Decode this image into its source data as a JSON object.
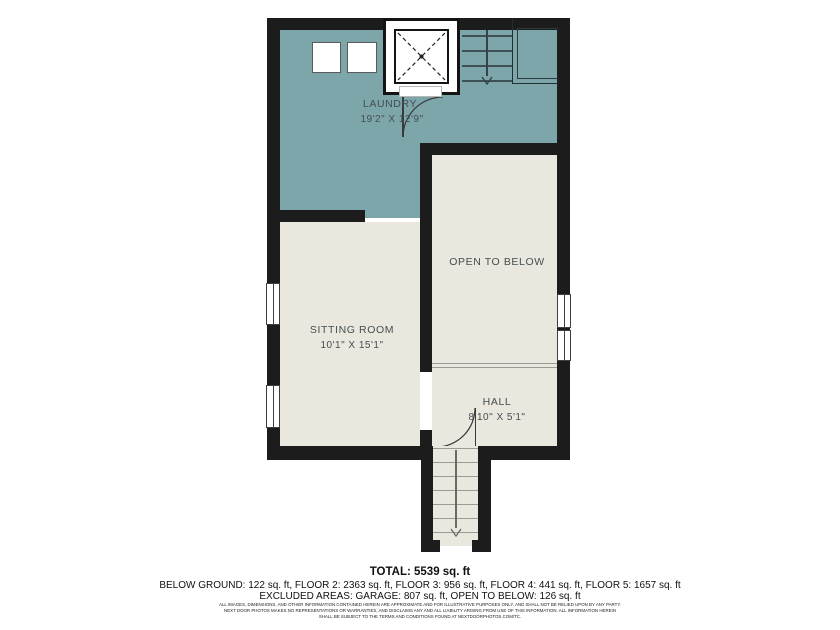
{
  "colors": {
    "wall": "#1c1c1c",
    "floor_teal": "#7da6ab",
    "floor_cream": "#e9e7de",
    "line_on_teal": "#3d5054",
    "line_on_cream": "#9b9b93",
    "label": "#454e51"
  },
  "rooms": {
    "laundry": {
      "name": "LAUNDRY",
      "dims": "19'2\" X 12'9\""
    },
    "sitting_room": {
      "name": "SITTING ROOM",
      "dims": "10'1\" X 15'1\""
    },
    "hall": {
      "name": "HALL",
      "dims": "8'10\" X 5'1\""
    },
    "open_to_below": {
      "name": "OPEN TO BELOW"
    }
  },
  "summary": {
    "total": "TOTAL: 5539 sq. ft",
    "floors": "BELOW GROUND: 122 sq. ft, FLOOR 2: 2363 sq. ft, FLOOR 3: 956 sq. ft, FLOOR 4: 441 sq. ft, FLOOR 5: 1657 sq. ft",
    "excluded": "EXCLUDED AREAS: GARAGE: 807 sq. ft, OPEN TO BELOW: 126 sq. ft"
  },
  "disclaimer": {
    "line1": "ALL IMAGES, DIMENSIONS, AND OTHER INFORMATION CONTAINED HEREIN ARE APPROXIMATE AND FOR ILLUSTRATIVE PURPOSES ONLY, AND SHALL NOT BE RELIED UPON BY ANY PARTY.",
    "line2": "NEXT DOOR PHOTOS MAKES NO REPRESENTATIONS OR WARRANTIES, AND DISCLAIMS ANY AND ALL LIABILITY ARISING FROM USE OF THIS INFORMATION. ALL INFORMATION HEREIN",
    "line3": "SHALL BE SUBJECT TO THE TERMS AND CONDITIONS FOUND AT NEXTDOORPHOTOS.COM/TC."
  }
}
